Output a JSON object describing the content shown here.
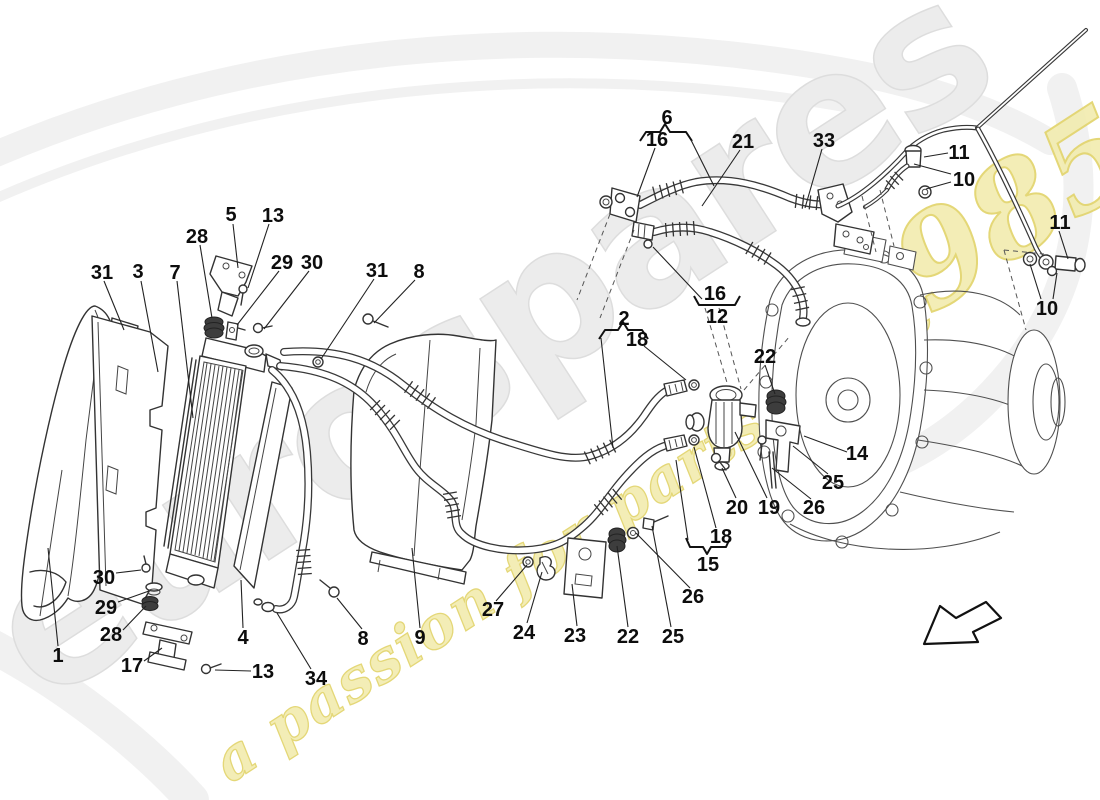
{
  "watermark": {
    "brand": "eurospares",
    "tagline": "a passion for parts since",
    "year": "1985"
  },
  "callouts": [
    {
      "n": "1",
      "x": 58,
      "y": 655,
      "leaders": [
        [
          58,
          646,
          48,
          548
        ]
      ]
    },
    {
      "n": "2",
      "x": 624,
      "y": 318,
      "leaders": [
        [
          601,
          338,
          613,
          448
        ]
      ]
    },
    {
      "n": "3",
      "x": 138,
      "y": 271,
      "leaders": [
        [
          141,
          281,
          158,
          372
        ]
      ]
    },
    {
      "n": "4",
      "x": 243,
      "y": 637,
      "leaders": [
        [
          243,
          628,
          241,
          580
        ]
      ]
    },
    {
      "n": "5",
      "x": 231,
      "y": 214,
      "leaders": [
        [
          233,
          224,
          238,
          268
        ]
      ]
    },
    {
      "n": "6",
      "x": 667,
      "y": 117,
      "leaders": [
        [
          691,
          140,
          714,
          186
        ]
      ]
    },
    {
      "n": "7",
      "x": 175,
      "y": 272,
      "leaders": [
        [
          177,
          281,
          193,
          418
        ]
      ]
    },
    {
      "n": "8",
      "x": 419,
      "y": 271,
      "leaders": [
        [
          415,
          280,
          374,
          323
        ]
      ]
    },
    {
      "n": "8",
      "x": 363,
      "y": 638,
      "leaders": [
        [
          362,
          629,
          337,
          598
        ]
      ]
    },
    {
      "n": "9",
      "x": 420,
      "y": 637,
      "leaders": [
        [
          420,
          628,
          412,
          548
        ]
      ]
    },
    {
      "n": "10",
      "x": 964,
      "y": 179,
      "leaders": [
        [
          951,
          174,
          914,
          164
        ],
        [
          951,
          182,
          926,
          189
        ]
      ]
    },
    {
      "n": "10",
      "x": 1047,
      "y": 308,
      "leaders": [
        [
          1041,
          299,
          1030,
          264
        ],
        [
          1053,
          299,
          1057,
          273
        ]
      ]
    },
    {
      "n": "11",
      "x": 959,
      "y": 152,
      "leaders": [
        [
          948,
          153,
          924,
          157
        ]
      ]
    },
    {
      "n": "11",
      "x": 1060,
      "y": 222,
      "leaders": [
        [
          1059,
          231,
          1068,
          259
        ]
      ]
    },
    {
      "n": "12",
      "x": 717,
      "y": 316,
      "leaders": []
    },
    {
      "n": "13",
      "x": 273,
      "y": 215,
      "leaders": [
        [
          269,
          224,
          248,
          288
        ]
      ]
    },
    {
      "n": "13",
      "x": 263,
      "y": 671,
      "leaders": [
        [
          251,
          671,
          215,
          670
        ]
      ]
    },
    {
      "n": "14",
      "x": 857,
      "y": 453,
      "leaders": [
        [
          847,
          452,
          804,
          436
        ]
      ]
    },
    {
      "n": "15",
      "x": 708,
      "y": 564,
      "leaders": [
        [
          688,
          540,
          676,
          460
        ]
      ]
    },
    {
      "n": "16",
      "x": 657,
      "y": 139,
      "leaders": [
        [
          655,
          148,
          637,
          197
        ]
      ]
    },
    {
      "n": "16",
      "x": 715,
      "y": 293,
      "leaders": [
        [
          702,
          299,
          653,
          247
        ]
      ]
    },
    {
      "n": "17",
      "x": 132,
      "y": 665,
      "leaders": [
        [
          144,
          661,
          162,
          648
        ]
      ]
    },
    {
      "n": "18",
      "x": 637,
      "y": 339,
      "leaders": [
        [
          644,
          346,
          686,
          380
        ]
      ]
    },
    {
      "n": "18",
      "x": 721,
      "y": 536,
      "leaders": [
        [
          716,
          528,
          694,
          447
        ]
      ]
    },
    {
      "n": "19",
      "x": 769,
      "y": 507,
      "leaders": [
        [
          767,
          498,
          735,
          432
        ]
      ]
    },
    {
      "n": "20",
      "x": 737,
      "y": 507,
      "leaders": [
        [
          736,
          498,
          722,
          468
        ]
      ]
    },
    {
      "n": "21",
      "x": 743,
      "y": 141,
      "leaders": [
        [
          740,
          150,
          702,
          206
        ]
      ]
    },
    {
      "n": "22",
      "x": 765,
      "y": 356,
      "leaders": [
        [
          765,
          365,
          775,
          394
        ]
      ]
    },
    {
      "n": "22",
      "x": 628,
      "y": 636,
      "leaders": [
        [
          628,
          627,
          617,
          546
        ]
      ]
    },
    {
      "n": "23",
      "x": 575,
      "y": 635,
      "leaders": [
        [
          577,
          626,
          572,
          584
        ]
      ]
    },
    {
      "n": "24",
      "x": 524,
      "y": 632,
      "leaders": [
        [
          527,
          623,
          542,
          572
        ]
      ]
    },
    {
      "n": "25",
      "x": 833,
      "y": 482,
      "leaders": [
        [
          828,
          474,
          793,
          446
        ]
      ]
    },
    {
      "n": "25",
      "x": 673,
      "y": 636,
      "leaders": [
        [
          671,
          627,
          652,
          526
        ]
      ]
    },
    {
      "n": "26",
      "x": 814,
      "y": 507,
      "leaders": [
        [
          811,
          499,
          772,
          468
        ]
      ]
    },
    {
      "n": "26",
      "x": 693,
      "y": 596,
      "leaders": [
        [
          690,
          588,
          636,
          533
        ]
      ]
    },
    {
      "n": "27",
      "x": 493,
      "y": 609,
      "leaders": [
        [
          496,
          601,
          527,
          565
        ]
      ]
    },
    {
      "n": "28",
      "x": 197,
      "y": 236,
      "leaders": [
        [
          200,
          245,
          212,
          318
        ]
      ]
    },
    {
      "n": "28",
      "x": 111,
      "y": 634,
      "leaders": [
        [
          123,
          630,
          146,
          606
        ]
      ]
    },
    {
      "n": "29",
      "x": 282,
      "y": 262,
      "leaders": [
        [
          279,
          271,
          237,
          325
        ]
      ]
    },
    {
      "n": "29",
      "x": 106,
      "y": 607,
      "leaders": [
        [
          118,
          602,
          149,
          591
        ]
      ]
    },
    {
      "n": "30",
      "x": 312,
      "y": 262,
      "leaders": [
        [
          309,
          271,
          264,
          329
        ]
      ]
    },
    {
      "n": "30",
      "x": 104,
      "y": 577,
      "leaders": [
        [
          116,
          573,
          141,
          570
        ]
      ]
    },
    {
      "n": "31",
      "x": 102,
      "y": 272,
      "leaders": [
        [
          104,
          281,
          124,
          330
        ]
      ]
    },
    {
      "n": "31",
      "x": 377,
      "y": 270,
      "leaders": [
        [
          374,
          279,
          321,
          359
        ]
      ]
    },
    {
      "n": "33",
      "x": 824,
      "y": 140,
      "leaders": [
        [
          822,
          149,
          805,
          208
        ]
      ]
    },
    {
      "n": "34",
      "x": 316,
      "y": 678,
      "leaders": [
        [
          311,
          669,
          277,
          613
        ]
      ]
    }
  ]
}
